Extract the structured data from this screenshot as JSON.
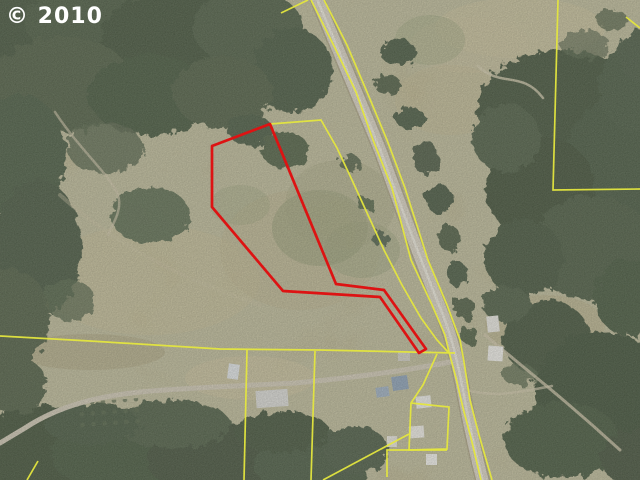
{
  "watermark": {
    "text": "© 2010"
  },
  "colors": {
    "parcel_outline_red": "#dd1313",
    "cadastral_yellow": "#e4e63e",
    "field_tan": "#b7ae87",
    "forest_green": "#4e5d45",
    "road_grey": "#d8d2c2"
  },
  "map_overlays": {
    "red_parcel": {
      "name": "subject-property-boundary",
      "points": [
        [
          270,
          124
        ],
        [
          336,
          284
        ],
        [
          384,
          290
        ],
        [
          426,
          349
        ],
        [
          419,
          353
        ],
        [
          380,
          297
        ],
        [
          283,
          291
        ],
        [
          212,
          207
        ],
        [
          212,
          146
        ]
      ]
    },
    "yellow_lines": [
      {
        "name": "road-west-parcel-line",
        "points": [
          [
            311,
            0
          ],
          [
            335,
            48
          ],
          [
            356,
            92
          ],
          [
            373,
            140
          ],
          [
            392,
            188
          ],
          [
            411,
            260
          ],
          [
            432,
            305
          ],
          [
            445,
            335
          ],
          [
            449,
            352
          ],
          [
            456,
            378
          ],
          [
            463,
            408
          ],
          [
            471,
            438
          ],
          [
            481,
            480
          ]
        ]
      },
      {
        "name": "road-east-parcel-line",
        "points": [
          [
            324,
            0
          ],
          [
            347,
            45
          ],
          [
            367,
            92
          ],
          [
            387,
            140
          ],
          [
            405,
            188
          ],
          [
            428,
            260
          ],
          [
            447,
            305
          ],
          [
            460,
            340
          ],
          [
            464,
            362
          ],
          [
            470,
            400
          ],
          [
            479,
            435
          ],
          [
            492,
            480
          ]
        ]
      },
      {
        "name": "west-offset-parcel-line",
        "points": [
          [
            270,
            124
          ],
          [
            321,
            120
          ],
          [
            337,
            148
          ],
          [
            352,
            180
          ],
          [
            368,
            215
          ],
          [
            384,
            250
          ],
          [
            402,
            285
          ],
          [
            421,
            318
          ],
          [
            437,
            340
          ],
          [
            448,
            352
          ]
        ]
      },
      {
        "name": "south-parcel-line",
        "points": [
          [
            0,
            336
          ],
          [
            90,
            341
          ],
          [
            220,
            349
          ],
          [
            320,
            350
          ],
          [
            455,
            353
          ]
        ]
      },
      {
        "name": "south-lot-line-1",
        "points": [
          [
            247,
            350
          ],
          [
            244,
            480
          ]
        ]
      },
      {
        "name": "south-lot-line-2",
        "points": [
          [
            315,
            351
          ],
          [
            311,
            480
          ]
        ]
      },
      {
        "name": "northeast-parcel-line",
        "points": [
          [
            558,
            0
          ],
          [
            553,
            190
          ],
          [
            640,
            189
          ]
        ]
      },
      {
        "name": "north-edge-segment",
        "points": [
          [
            308,
            0
          ],
          [
            281,
            13
          ]
        ]
      },
      {
        "name": "northeast-edge-segment",
        "points": [
          [
            626,
            17
          ],
          [
            640,
            28
          ]
        ]
      },
      {
        "name": "homestead-lot-line-1",
        "points": [
          [
            437,
            354
          ],
          [
            423,
            385
          ],
          [
            411,
            403
          ],
          [
            409,
            450
          ],
          [
            447,
            449
          ],
          [
            449,
            407
          ],
          [
            411,
            403
          ]
        ]
      },
      {
        "name": "homestead-lot-line-2",
        "points": [
          [
            387,
            477
          ],
          [
            387,
            450
          ],
          [
            447,
            450
          ]
        ]
      },
      {
        "name": "homestead-lot-line-3",
        "points": [
          [
            409,
            434
          ],
          [
            323,
            480
          ]
        ]
      },
      {
        "name": "southwest-corner-segment",
        "points": [
          [
            38,
            461
          ],
          [
            27,
            480
          ]
        ]
      }
    ]
  }
}
